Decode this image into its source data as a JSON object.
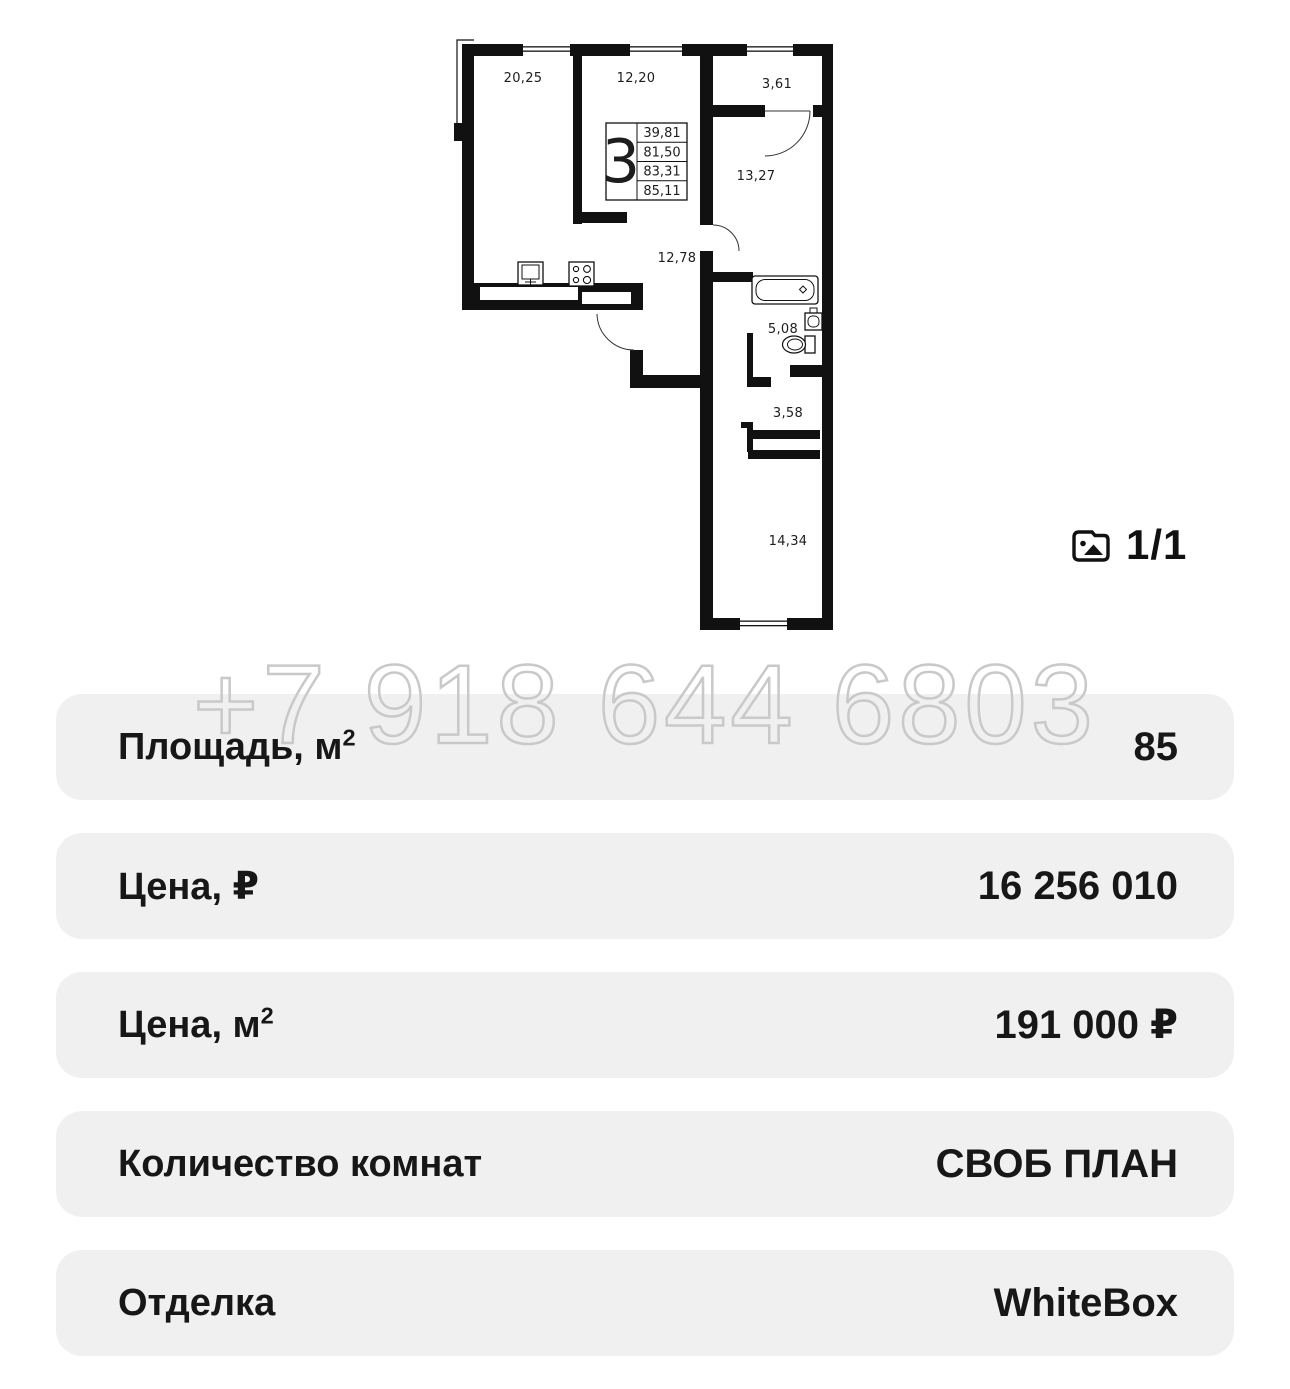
{
  "plan": {
    "type_number": "3",
    "areas": [
      "39,81",
      "81,50",
      "83,31",
      "85,11"
    ],
    "rooms": {
      "kitchen_living": "20,25",
      "bedroom": "12,20",
      "loggia": "3,61",
      "room_right": "13,27",
      "hallway": "12,78",
      "bathroom": "5,08",
      "entry": "3,58",
      "room_bottom": "14,34"
    }
  },
  "gallery": {
    "counter": "1/1"
  },
  "watermark": {
    "phone": "+7 918 644 6803"
  },
  "specs": [
    {
      "label": "Площадь, м",
      "label_sup": "2",
      "value": "85"
    },
    {
      "label": "Цена, ₽",
      "label_sup": "",
      "value": "16 256 010"
    },
    {
      "label": "Цена, м",
      "label_sup": "2",
      "value": "191 000 ₽"
    },
    {
      "label": "Количество комнат",
      "label_sup": "",
      "value": "СВОБ ПЛАН"
    },
    {
      "label": "Отделка",
      "label_sup": "",
      "value": "WhiteBox"
    }
  ],
  "colors": {
    "row_bg": "#f0f0f0",
    "text": "#171717",
    "watermark_stroke": "#c9c9c9",
    "plan_line": "#111111"
  }
}
